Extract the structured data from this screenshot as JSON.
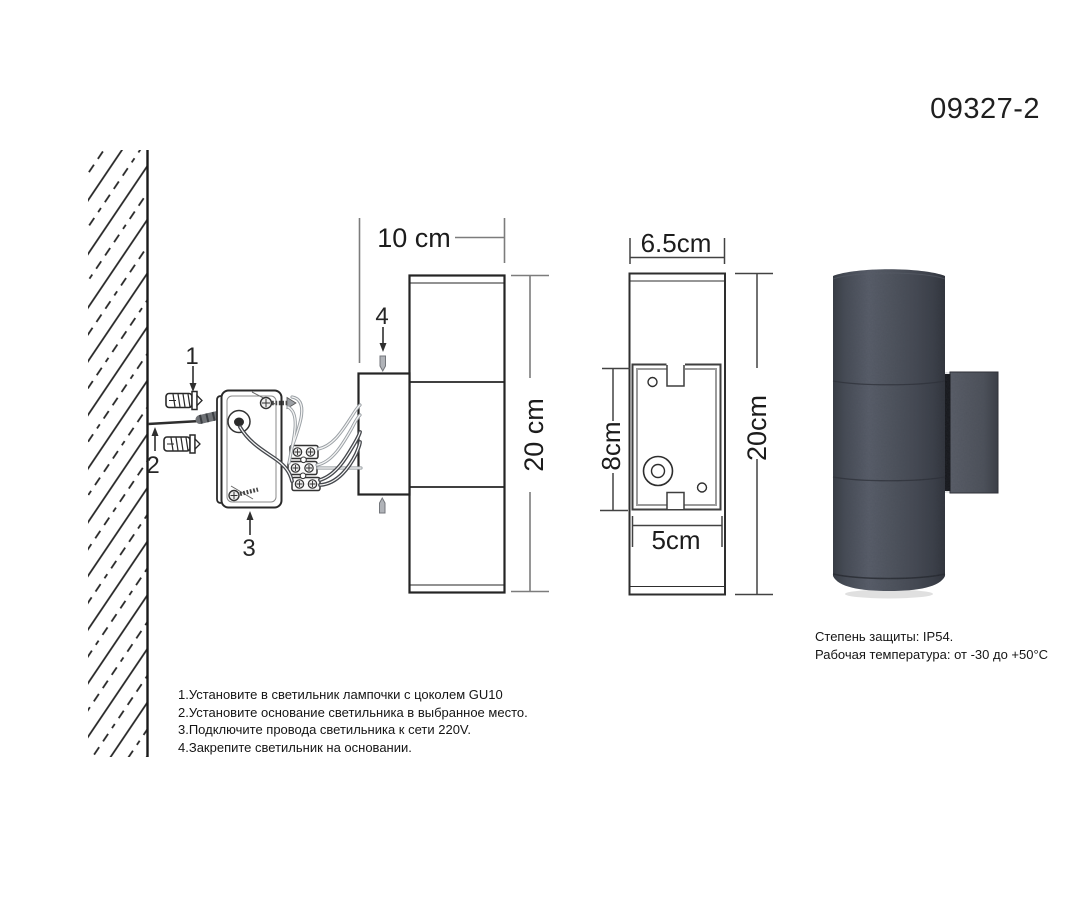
{
  "product": {
    "model": "09327-2"
  },
  "markers": {
    "m1": "1",
    "m2": "2",
    "m3": "3",
    "m4": "4"
  },
  "side_view": {
    "depth_label": "10 cm",
    "height_label": "20 cm"
  },
  "rear_view": {
    "width_label": "6.5cm",
    "height_label": "20cm",
    "plate_height_label": "8cm",
    "plate_width_label": "5cm"
  },
  "instructions": [
    "1.Установите в светильник лампочки с цоколем GU10",
    "2.Установите основание светильника в выбранное место.",
    "3.Подключите провода светильника к сети 220V.",
    "4.Закрепите светильник на основании."
  ],
  "specs": [
    "Степень защиты: IP54.",
    "Рабочая температура: от -30 до +50°C"
  ],
  "colors": {
    "line": "#262626",
    "dim_line_light": "#7c7c7c",
    "dim_line_dark": "#424242",
    "lamp_body": "#4d525c",
    "lamp_dark": "#2f323a"
  }
}
